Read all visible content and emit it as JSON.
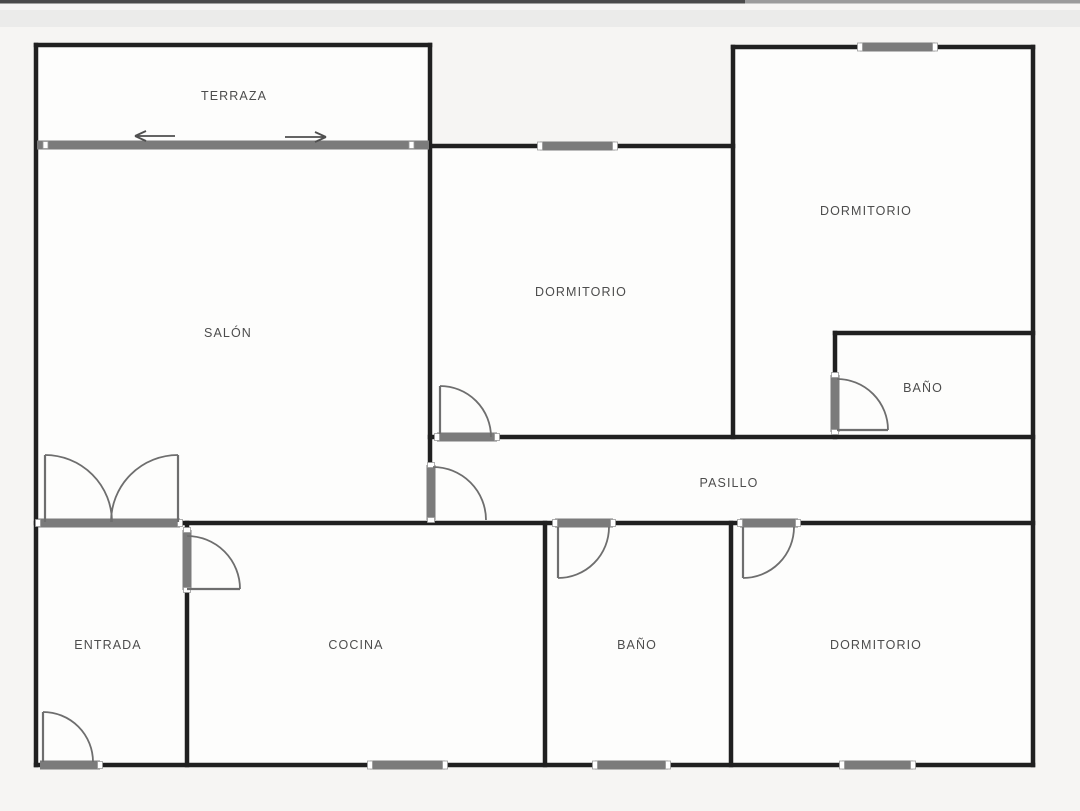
{
  "rooms": {
    "terraza": {
      "label": "TERRAZA"
    },
    "salon": {
      "label": "SALÓN"
    },
    "dormitorio_centro": {
      "label": "DORMITORIO"
    },
    "dormitorio_sup_dcha": {
      "label": "DORMITORIO"
    },
    "bano_dcha": {
      "label": "BAÑO"
    },
    "pasillo": {
      "label": "PASILLO"
    },
    "entrada": {
      "label": "ENTRADA"
    },
    "cocina": {
      "label": "COCINA"
    },
    "bano_inferior": {
      "label": "BAÑO"
    },
    "dormitorio_inferior": {
      "label": "DORMITORIO"
    }
  },
  "fixtures": {
    "windows": 5,
    "swing_doors": 7,
    "double_doors": 1,
    "sliding_doors": 1,
    "sliding_door_arrow_directions": [
      "left",
      "right"
    ]
  },
  "colors": {
    "wall": "#202020",
    "fixture_gray": "#7b7b7b",
    "door_arc": "#6e6e6e",
    "label_text": "#4d4d4d",
    "floor": "#fdfdfc",
    "background": "#f6f5f3"
  }
}
